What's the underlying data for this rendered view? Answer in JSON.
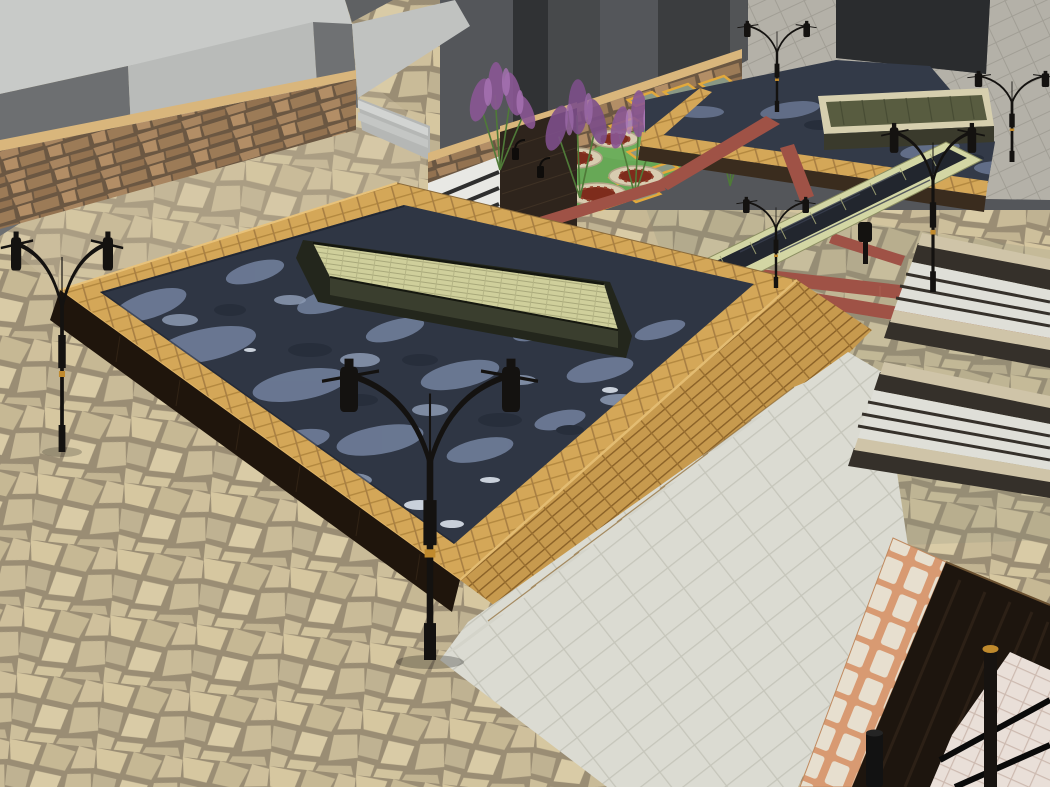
{
  "scene": {
    "title": "Architectural 3D render of a sunken plaza with reflecting pools",
    "view": "elevated three-quarter aerial perspective",
    "elements": [
      {
        "name": "background-buildings-light",
        "desc": "light gray massing blocks, upper left"
      },
      {
        "name": "background-buildings-dark",
        "desc": "dark gray massing blocks, upper center and right"
      },
      {
        "name": "stone-boundary-wall",
        "desc": "stacked rubble stone wall with tan coping"
      },
      {
        "name": "garden-terrace",
        "desc": "lawn with circular mulch planters, purple shrubs, framed stepping pavers"
      },
      {
        "name": "main-reflecting-pool",
        "desc": "large pool, brick coping, dark rippled water, stone trough island"
      },
      {
        "name": "upper-pool",
        "desc": "shallow pool along rear walkway with mossy stone planter box"
      },
      {
        "name": "water-channel",
        "desc": "raised stone-edged rill crossing the paving"
      },
      {
        "name": "paving-flagstone",
        "desc": "irregular beige flagstone paving"
      },
      {
        "name": "paving-plaza",
        "desc": "lower plaza of large light concrete pavers reached by steps"
      },
      {
        "name": "red-accent-bands",
        "desc": "brick red paving strips"
      },
      {
        "name": "street-lamps",
        "desc": "black double-arm ornamental lamp posts with gold rings"
      },
      {
        "name": "stairs",
        "desc": "stepped golden brick wall and twin dark-walled stair flights"
      },
      {
        "name": "corner-detail",
        "desc": "stone block border, dark timber band, tiles, railing, bollard"
      }
    ]
  },
  "palette": {
    "flag_bg": "#9a8d74",
    "roof_light": "#c8cac8",
    "face_bright": "#b9bbb9",
    "face_dark": "#6d6f71",
    "bldg_dark": "#3b3d3f",
    "backdrop_dark": "#54565a",
    "walkway_tile": "#b4b1a8",
    "wall_cap": "#d9b67c",
    "rubble_base": "#6b5742",
    "dark_brick_wall": "#2e241c",
    "lawn_green": "#67a856",
    "mulch_red": "#7e2c1c",
    "planter_ring": "#d8ccb0",
    "square_frame": "#e2a93c",
    "coping_tan": "#d4a758",
    "pool_water_dark": "#2f3644",
    "pool_ripple_light": "#6d7b96",
    "trough_fill": "#cfcf9b",
    "trough_wall": "#23261c",
    "gold_wall": "#c79a4e",
    "plaza_paver": "#dbdbd2",
    "red_band": "#9f5246",
    "channel_edge": "#d3d6a4",
    "channel_water": "#22262e",
    "border_mortar": "#d89a72",
    "border_block": "#e7dfcf",
    "timber_dark": "#1d150e",
    "tile_pink": "#e9dfd8",
    "lamp_black": "#141210",
    "lamp_gold": "#c08a2d",
    "step_white": "#e8e8e4"
  }
}
